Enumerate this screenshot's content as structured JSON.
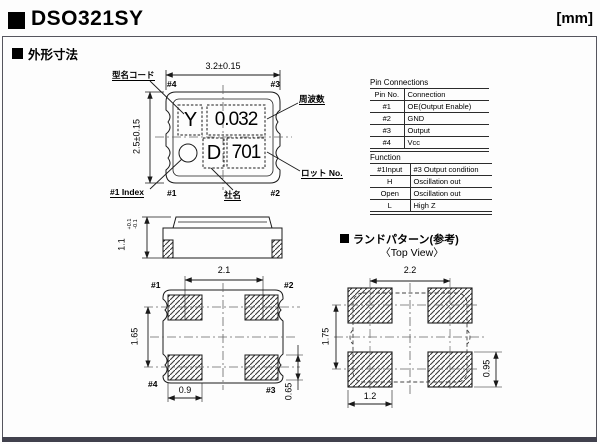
{
  "page": {
    "title": "DSO321SY",
    "unit": "[mm]"
  },
  "section": {
    "outline_title": "外形寸法"
  },
  "top_view": {
    "dim_width": "3.2±0.15",
    "dim_height": "2.5±0.15",
    "pins": {
      "tl": "#4",
      "tr": "#3",
      "bl": "#1",
      "br": "#2"
    },
    "label_model_code": "型名コード",
    "label_frequency": "周波数",
    "label_lot": "ロット No.",
    "label_company": "社名",
    "label_index": "#1 Index",
    "marking": {
      "model_code": "Y",
      "frequency": "0.032",
      "company": "D",
      "lot": "701"
    }
  },
  "side_view": {
    "dim_height": "1.1",
    "tol_upper": "+0.1",
    "tol_lower": "-0.1"
  },
  "bottom_view": {
    "dim_pitch_x": "2.1",
    "dim_pitch_y": "1.65",
    "dim_pad_w": "0.9",
    "dim_pad_h": "0.65",
    "pins": {
      "tl": "#1",
      "tr": "#2",
      "bl": "#4",
      "br": "#3"
    }
  },
  "land_pattern": {
    "title": "ランドパターン(参考)",
    "subtitle": "〈Top View〉",
    "dim_pitch_x": "2.2",
    "dim_pitch_y": "1.75",
    "dim_pad_w": "1.2",
    "dim_pad_h": "0.95"
  },
  "pin_connections": {
    "title": "Pin Connections",
    "headers": [
      "Pin No.",
      "Connection"
    ],
    "rows": [
      [
        "#1",
        "OE(Output Enable)"
      ],
      [
        "#2",
        "GND"
      ],
      [
        "#3",
        "Output"
      ],
      [
        "#4",
        "Vcc"
      ]
    ]
  },
  "function_table": {
    "title": "Function",
    "headers": [
      "#1Input",
      "#3 Output condition"
    ],
    "rows": [
      [
        "H",
        "Oscillation out"
      ],
      [
        "Open",
        "Oscillation out"
      ],
      [
        "L",
        "High Z"
      ]
    ]
  }
}
